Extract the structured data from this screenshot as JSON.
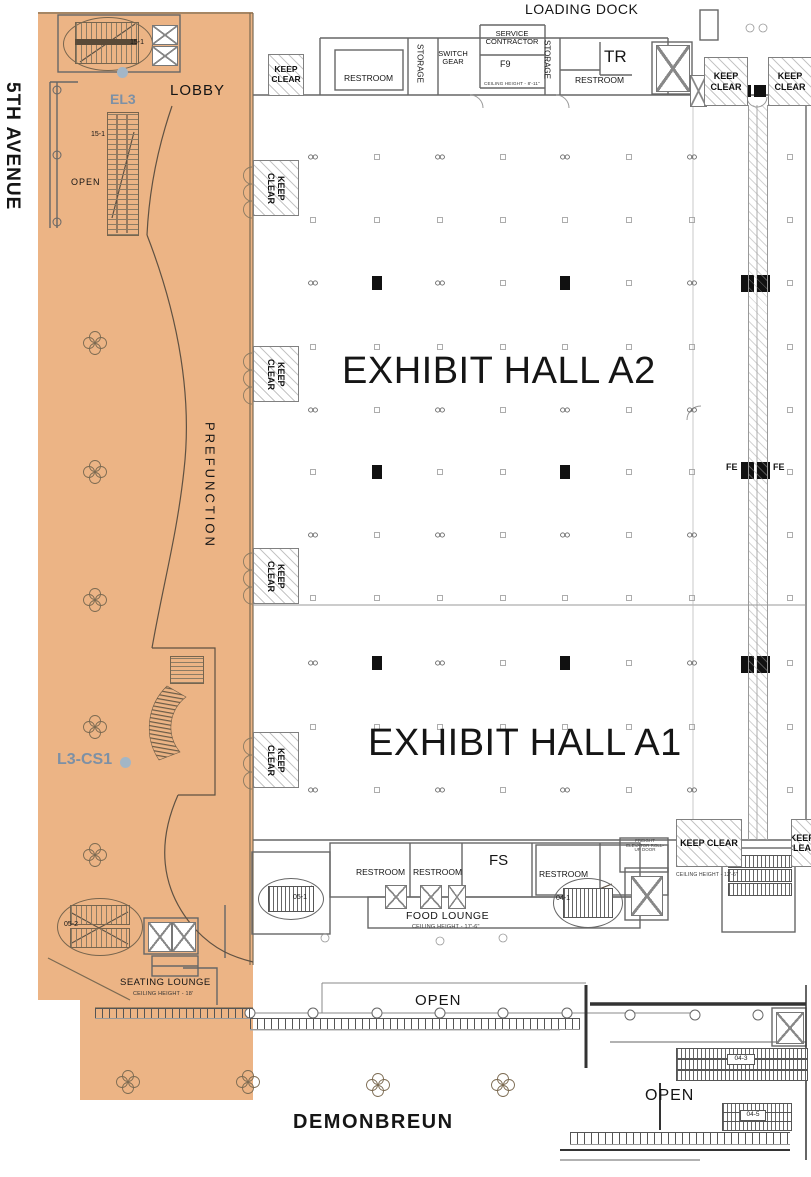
{
  "streets": {
    "left": "5TH AVENUE",
    "bottom": "DEMONBREUN"
  },
  "halls": {
    "a2": "EXHIBIT HALL A2",
    "a1": "EXHIBIT HALL A1"
  },
  "areas": {
    "lobby": "LOBBY",
    "open": "OPEN",
    "prefunction": "PREFUNCTION",
    "loading_dock": "LOADING DOCK",
    "seating_lounge": "SEATING LOUNGE",
    "seating_ceiling": "CEILING HEIGHT - 18'",
    "food_lounge": "FOOD LOUNGE",
    "food_ceiling": "CEILING HEIGHT - 17'-6\""
  },
  "rooms": {
    "restroom": "RESTROOM",
    "storage": "STORAGE",
    "switch_gear": "SWITCH GEAR",
    "service_contractor": "SERVICE CONTRACTOR",
    "tr": "TR",
    "f9": "F9",
    "f9_ceiling": "CEILING HEIGHT - 8'-11\"",
    "fs": "FS"
  },
  "markers": {
    "keep_clear": "KEEP CLEAR",
    "fe": "FE",
    "ceiling_12_6": "CEILING HEIGHT - 12'-6\"",
    "freight_note": "FREIGHT ELEVATOR ROLL-UP DOOR"
  },
  "units": {
    "el3": "EL3",
    "l3cs1": "L3-CS1",
    "e15_1": "15-1",
    "e05_1": "05-1",
    "e05_2": "05-2",
    "e04_1": "04-1",
    "e04_3": "04-3",
    "e04_5": "04-5"
  },
  "colors": {
    "highlight": "#ECB485",
    "unit_label": "#7D90A5",
    "wall": "#7B6A52"
  }
}
